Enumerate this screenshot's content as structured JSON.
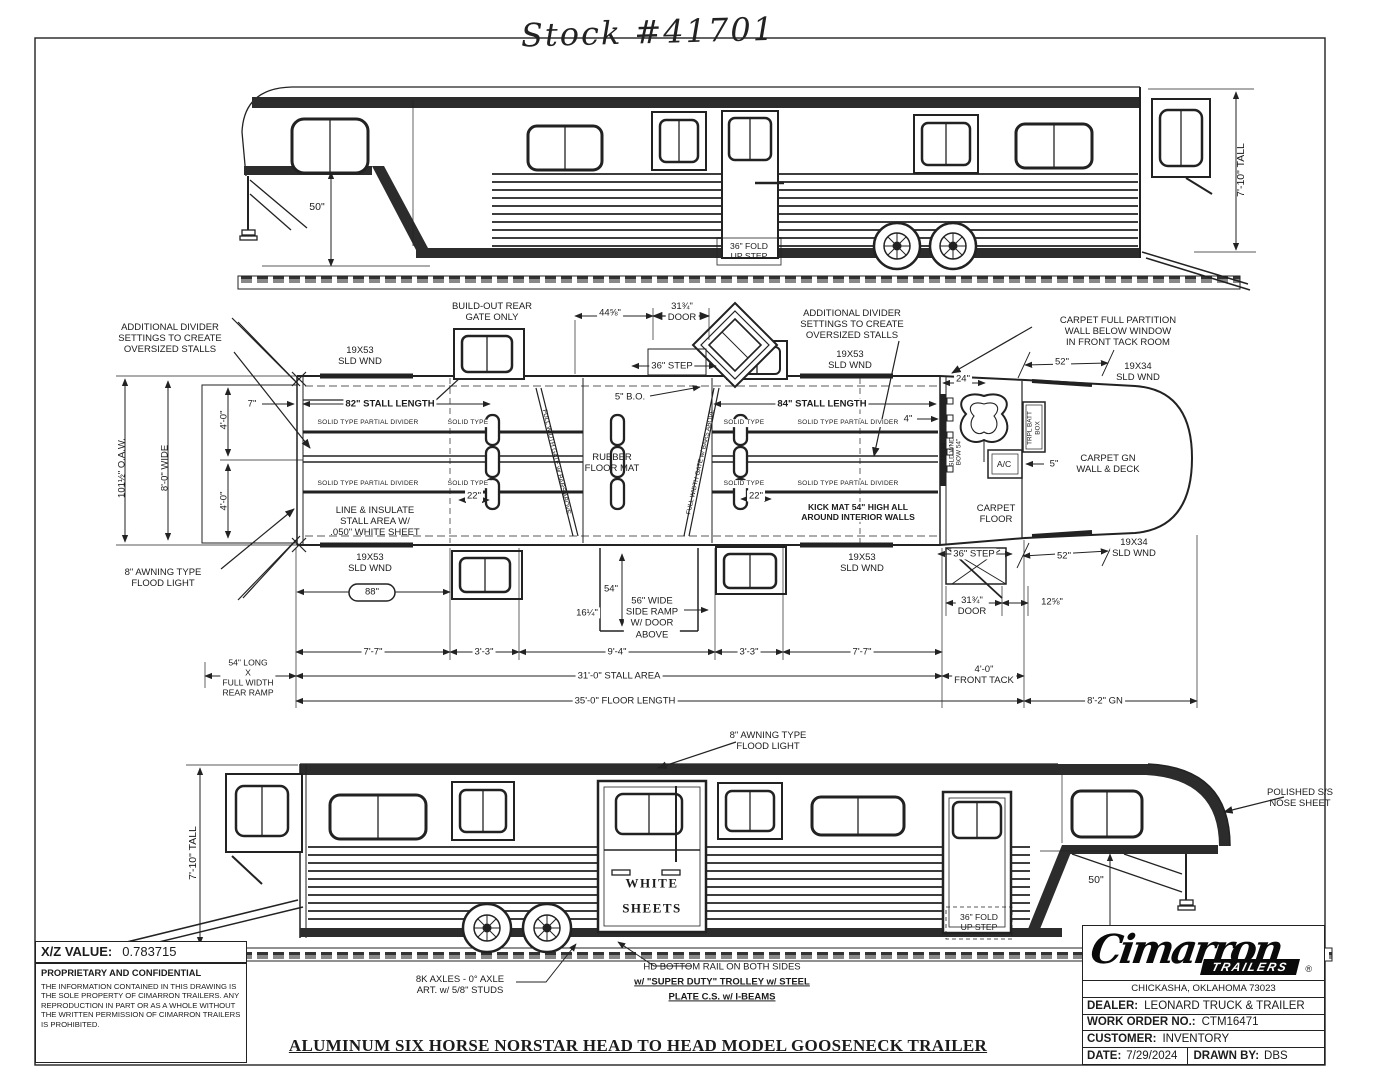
{
  "header": {
    "stock_number": "Stock #41701"
  },
  "top_view": {
    "dim_50": "50\"",
    "fold_step": "36\" FOLD\nUP STEP",
    "height": "7'-10\" TALL"
  },
  "plan": {
    "divider_note": "ADDITIONAL DIVIDER\nSETTINGS TO CREATE\nOVERSIZED STALLS",
    "wnd_19x53": "19X53\nSLD WND",
    "wnd_19x34": "19X34\nSLD WND",
    "wnd_bow": "19X34\nSLD WND\nBOW 54\"",
    "buildout_note": "BUILD-OUT REAR\nGATE ONLY",
    "dim_44_58": "44⅝\"",
    "door_31_34": "31¾\"\nDOOR",
    "step_36": "36\" STEP",
    "carpet_partition_note": "CARPET FULL PARTITION\nWALL BELOW WINDOW\nIN FRONT TACK ROOM",
    "dim_52": "52\"",
    "dim_7": "7\"",
    "stall_82": "82\" STALL LENGTH",
    "bo_5": "5\" B.O.",
    "stall_84": "84\" STALL LENGTH",
    "dim_4": "4\"",
    "dim_24": "24\"",
    "solid_partial": "SOLID TYPE PARTIAL DIVIDER",
    "solid_type": "SOLID TYPE",
    "rubber_mat": "RUBBER\nFLOOR MAT",
    "full_width_gate": "FULL WIDTH GATE w/ BARS ABOVE",
    "trpl_batt": "TRPL BATT\nBOX",
    "ac": "A/C",
    "dim_5": "5\"",
    "carpet_gn": "CARPET GN\nWALL & DECK",
    "line_insulate": "LINE & INSULATE\nSTALL AREA W/\n.050\" WHITE SHEET",
    "dim_22": "22\"",
    "kick_mat": "KICK MAT 54\" HIGH ALL\nAROUND INTERIOR WALLS",
    "carpet_floor": "CARPET\nFLOOR",
    "oaw": "101½\" O.A.W.",
    "wide_8": "8'-0\" WIDE",
    "dim_4ft": "4'-0\"",
    "awning_note": "8\" AWNING TYPE\nFLOOD LIGHT",
    "dim_88": "88\"",
    "dim_54": "54\"",
    "dim_16_14": "16¼\"",
    "side_ramp_note": "56\" WIDE\nSIDE RAMP\nW/ DOOR\nABOVE",
    "dim_12_58": "12⅝\"",
    "dim_7_7": "7'-7\"",
    "dim_3_3": "3'-3\"",
    "dim_9_4": "9'-4\"",
    "rear_ramp_note": "54\" LONG\nX\nFULL WIDTH\nREAR RAMP",
    "stall_area": "31'-0\" STALL AREA",
    "front_tack": "4'-0\"\nFRONT TACK",
    "floor_length": "35'-0\" FLOOR LENGTH",
    "gn_length": "8'-2\" GN"
  },
  "bottom_view": {
    "awning_note": "8\" AWNING TYPE\nFLOOD LIGHT",
    "height": "7'-10\" TALL",
    "white_sheets": "WHITE\nSHEETS",
    "polished_nose": "POLISHED S/S\nNOSE SHEET",
    "dim_50": "50\"",
    "fold_step": "36\" FOLD\nUP STEP",
    "axle_note": "8K AXLES - 0° AXLE\nART. w/ 5/8\" STUDS",
    "hd_rail_1": "HD BOTTOM RAIL ON BOTH SIDES",
    "hd_rail_2": "w/ \"SUPER DUTY\" TROLLEY w/ STEEL",
    "hd_rail_3": "PLATE C.S. w/ I-BEAMS"
  },
  "footer": {
    "main_title": "ALUMINUM SIX HORSE NORSTAR HEAD TO HEAD MODEL GOOSENECK TRAILER"
  },
  "info_block": {
    "xz_label": "X/Z VALUE:",
    "xz_value": "0.783715",
    "prop_title": "PROPRIETARY AND CONFIDENTIAL",
    "prop_text": "THE INFORMATION CONTAINED IN THIS DRAWING IS THE SOLE PROPERTY OF CIMARRON TRAILERS.  ANY REPRODUCTION IN PART OR AS A WHOLE WITHOUT THE WRITTEN PERMISSION OF CIMARRON TRAILERS IS PROHIBITED."
  },
  "title_block": {
    "logo_main": "Cimarron",
    "logo_band": "TRAILERS",
    "logo_reg": "®",
    "city": "CHICKASHA, OKLAHOMA 73023",
    "dealer_label": "DEALER:",
    "dealer_value": "LEONARD TRUCK & TRAILER",
    "wo_label": "WORK ORDER NO.:",
    "wo_value": "CTM16471",
    "customer_label": "CUSTOMER:",
    "customer_value": "INVENTORY",
    "date_label": "DATE:",
    "date_value": "7/29/2024",
    "drawn_label": "DRAWN BY:",
    "drawn_value": "DBS"
  }
}
